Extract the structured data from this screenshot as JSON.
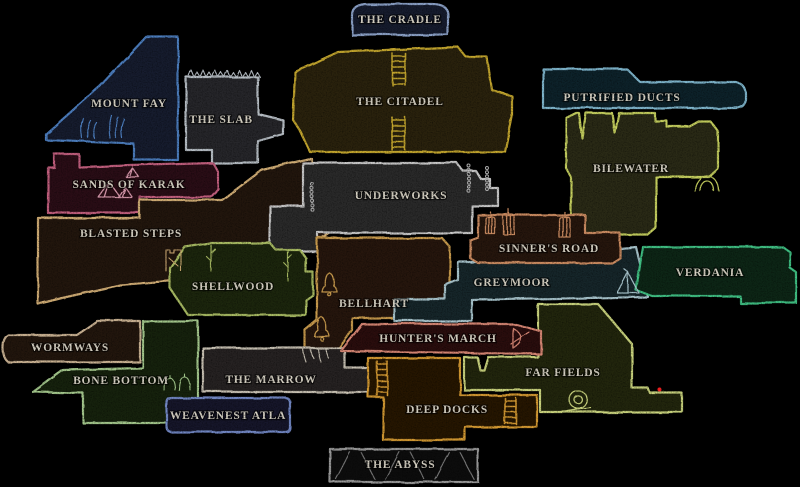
{
  "map": {
    "title": "world-map",
    "background": "#000000",
    "label_color": "#d9d4c6",
    "marker_color": "#ff2020",
    "regions": [
      {
        "id": "the-cradle",
        "label": "THE CRADLE",
        "border": "#8da3c9",
        "fill": "#151b2d"
      },
      {
        "id": "mount-fay",
        "label": "MOUNT FAY",
        "border": "#4d7fc0",
        "fill": "#121b2e"
      },
      {
        "id": "the-slab",
        "label": "THE SLAB",
        "border": "#b9c0c7",
        "fill": "#262829"
      },
      {
        "id": "the-citadel",
        "label": "THE CITADEL",
        "border": "#c5a72e",
        "fill": "#292310"
      },
      {
        "id": "putrified-ducts",
        "label": "PUTRIFIED DUCTS",
        "border": "#7fb6cd",
        "fill": "#11222b"
      },
      {
        "id": "bilewater",
        "label": "BILEWATER",
        "border": "#c6d05e",
        "fill": "#292b12"
      },
      {
        "id": "sands-of-karak",
        "label": "SANDS OF KARAK",
        "border": "#c4607f",
        "fill": "#2b1019"
      },
      {
        "id": "blasted-steps",
        "label": "BLASTED STEPS",
        "border": "#d3af76",
        "fill": "#231610"
      },
      {
        "id": "underworks",
        "label": "UNDERWORKS",
        "border": "#c9c9c9",
        "fill": "#2a2a2a"
      },
      {
        "id": "shellwood",
        "label": "SHELLWOOD",
        "border": "#a9bc64",
        "fill": "#1f250e"
      },
      {
        "id": "bellhart",
        "label": "BELLHART",
        "border": "#c99b4e",
        "fill": "#26190b"
      },
      {
        "id": "greymoor",
        "label": "GREYMOOR",
        "border": "#a9c6ce",
        "fill": "#172529"
      },
      {
        "id": "sinners-road",
        "label": "SINNER'S ROAD",
        "border": "#cd8d62",
        "fill": "#28140c"
      },
      {
        "id": "verdania",
        "label": "VERDANIA",
        "border": "#3fc184",
        "fill": "#0c2518"
      },
      {
        "id": "wormways",
        "label": "WORMWAYS",
        "border": "#cbb393",
        "fill": "#24190f"
      },
      {
        "id": "bone-bottom",
        "label": "BONE BOTTOM",
        "border": "#a5c98d",
        "fill": "#15220e"
      },
      {
        "id": "the-marrow",
        "label": "THE MARROW",
        "border": "#c9c2b4",
        "fill": "#262421"
      },
      {
        "id": "weavenest-atla",
        "label": "WEAVENEST ATLA",
        "border": "#7287c4",
        "fill": "#12192b"
      },
      {
        "id": "far-fields",
        "label": "FAR FIELDS",
        "border": "#ccd67f",
        "fill": "#23250d"
      },
      {
        "id": "hunters-march",
        "label": "HUNTER'S MARCH",
        "border": "#d98875",
        "fill": "#2b0f0c"
      },
      {
        "id": "deep-docks",
        "label": "DEEP DOCKS",
        "border": "#d59a33",
        "fill": "#261706"
      },
      {
        "id": "the-abyss",
        "label": "THE ABYSS",
        "border": "#9a9a9a",
        "fill": "#0c0c0c"
      }
    ],
    "icons": [
      {
        "name": "ladder-icon",
        "color": "#c5a72e",
        "x": 392,
        "y": 53,
        "w": 13,
        "h": 32
      },
      {
        "name": "ladder-icon",
        "color": "#c5a72e",
        "x": 392,
        "y": 117,
        "w": 13,
        "h": 33
      },
      {
        "name": "ladder-icon",
        "color": "#d59a33",
        "x": 377,
        "y": 361,
        "w": 10,
        "h": 34
      },
      {
        "name": "ladder-icon",
        "color": "#d59a33",
        "x": 505,
        "y": 398,
        "w": 11,
        "h": 26
      },
      {
        "name": "bell-icon",
        "color": "#c99b4e",
        "x": 322,
        "y": 273,
        "w": 15,
        "h": 19
      },
      {
        "name": "bell-icon",
        "color": "#c99b4e",
        "x": 314,
        "y": 317,
        "w": 15,
        "h": 19
      },
      {
        "name": "cage-icon",
        "color": "#cd8d62",
        "x": 486,
        "y": 217,
        "w": 9,
        "h": 17
      },
      {
        "name": "cage-icon",
        "color": "#cd8d62",
        "x": 503,
        "y": 214,
        "w": 11,
        "h": 20
      },
      {
        "name": "cage-icon",
        "color": "#cd8d62",
        "x": 559,
        "y": 217,
        "w": 11,
        "h": 20
      },
      {
        "name": "chain-icon",
        "color": "#b5b5b5",
        "x": 312,
        "y": 184,
        "w": 0,
        "h": 28
      },
      {
        "name": "chain-icon",
        "color": "#b5b5b5",
        "x": 469,
        "y": 166,
        "w": 0,
        "h": 28
      },
      {
        "name": "chain-icon",
        "color": "#b5b5b5",
        "x": 487,
        "y": 168,
        "w": 0,
        "h": 24
      },
      {
        "name": "tent-icon",
        "color": "#a9c6ce",
        "x": 617,
        "y": 272,
        "w": 22,
        "h": 21
      },
      {
        "name": "bow-icon",
        "color": "#d98875",
        "x": 513,
        "y": 328,
        "w": 13,
        "h": 20
      },
      {
        "name": "snail-icon",
        "color": "#ccd67f",
        "x": 563,
        "y": 391,
        "w": 28,
        "h": 21
      },
      {
        "name": "map-marker-dot",
        "color": "#ff2020",
        "x": 660,
        "y": 390,
        "w": 4,
        "h": 4
      },
      {
        "name": "pyramid-icon",
        "color": "#d898ac",
        "x": 98,
        "y": 182,
        "w": 22,
        "h": 15
      },
      {
        "name": "pyramid-icon",
        "color": "#d898ac",
        "x": 118,
        "y": 187,
        "w": 14,
        "h": 10
      },
      {
        "name": "pyramid-icon",
        "color": "#d898ac",
        "x": 126,
        "y": 168,
        "w": 13,
        "h": 9
      },
      {
        "name": "reeds-icon",
        "color": "#4d7fc0",
        "x": 82,
        "y": 118,
        "w": 16,
        "h": 20
      },
      {
        "name": "reeds-icon",
        "color": "#4d7fc0",
        "x": 110,
        "y": 115,
        "w": 16,
        "h": 23
      },
      {
        "name": "spikes-icon",
        "color": "#b9c0c7",
        "x": 188,
        "y": 77,
        "w": 68,
        "h": 7
      },
      {
        "name": "arch-icon",
        "color": "#c6d05e",
        "x": 695,
        "y": 176,
        "w": 24,
        "h": 15
      },
      {
        "name": "ruin-tower-icon",
        "color": "#d3af76",
        "x": 166,
        "y": 250,
        "w": 15,
        "h": 21
      },
      {
        "name": "sprout-icon",
        "color": "#a5c98d",
        "x": 164,
        "y": 378,
        "w": 11,
        "h": 12
      },
      {
        "name": "sprout-icon",
        "color": "#a5c98d",
        "x": 179,
        "y": 377,
        "w": 11,
        "h": 13
      },
      {
        "name": "claws-icon",
        "color": "#c9c2b4",
        "x": 303,
        "y": 349,
        "w": 24,
        "h": 13
      },
      {
        "name": "trunk-icon",
        "color": "#a9bc64",
        "x": 211,
        "y": 245,
        "w": 6,
        "h": 26
      },
      {
        "name": "trunk-icon",
        "color": "#a9bc64",
        "x": 288,
        "y": 251,
        "w": 6,
        "h": 30
      },
      {
        "name": "shards-icon",
        "color": "#8a8a8a",
        "x": 336,
        "y": 452,
        "w": 136,
        "h": 27
      }
    ]
  }
}
